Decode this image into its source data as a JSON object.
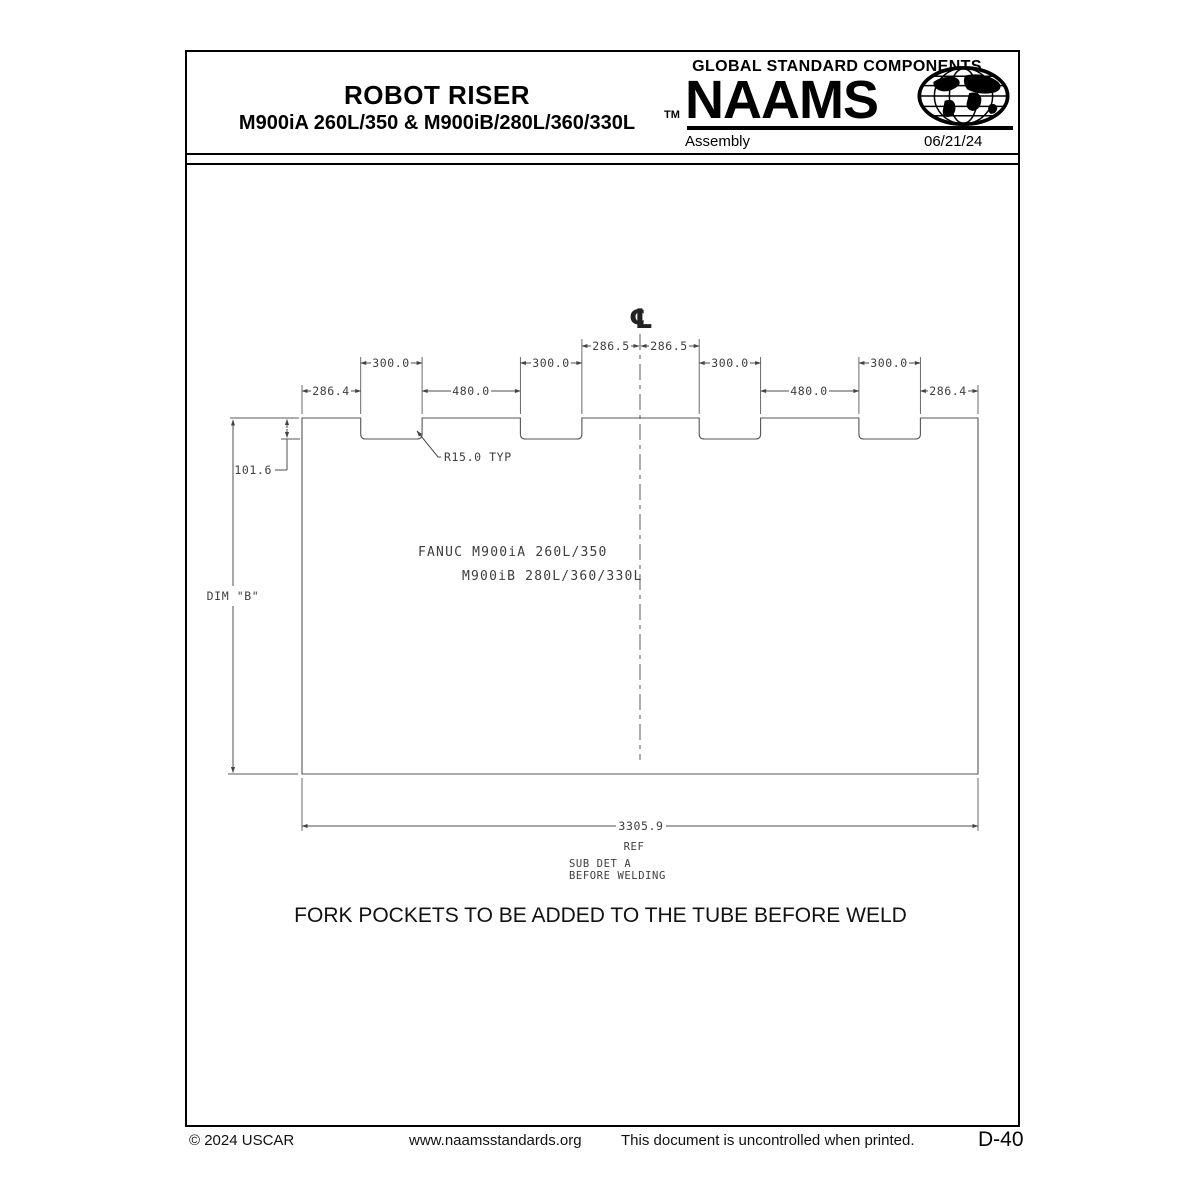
{
  "header": {
    "title": "ROBOT RISER",
    "subtitle": "M900iA 260L/350 & M900iB/280L/360/330L",
    "brand": {
      "tagline": "GLOBAL STANDARD COMPONENTS",
      "name": "NAAMS",
      "trademark": "TM",
      "globe_icon": "globe-icon",
      "color": "#000000"
    },
    "category": "Assembly",
    "date": "06/21/24"
  },
  "drawing": {
    "centerline_symbol": "℄",
    "dim_center_left": "286.5",
    "dim_center_right": "286.5",
    "pocket_widths": [
      "300.0",
      "300.0",
      "300.0",
      "300.0"
    ],
    "gap_widths": [
      "480.0",
      "480.0"
    ],
    "edge_widths": [
      "286.4",
      "286.4"
    ],
    "pocket_depth": "101.6",
    "corner_radius_note": "R15.0 TYP",
    "height_dim": "DIM \"B\"",
    "robot_line1": "FANUC M900iA 260L/350",
    "robot_line2": "M900iB 280L/360/330L",
    "overall_length": "3305.9",
    "overall_length_qualifier": "REF",
    "sub_detail_line1": "SUB DET A",
    "sub_detail_line2": "BEFORE WELDING",
    "line_color": "#555555"
  },
  "note": "FORK POCKETS TO BE ADDED TO THE TUBE BEFORE WELD",
  "footer": {
    "copyright": "© 2024  USCAR",
    "website": "www.naamsstandards.org",
    "disclaimer": "This document is uncontrolled when printed.",
    "page_number": "D-40"
  }
}
